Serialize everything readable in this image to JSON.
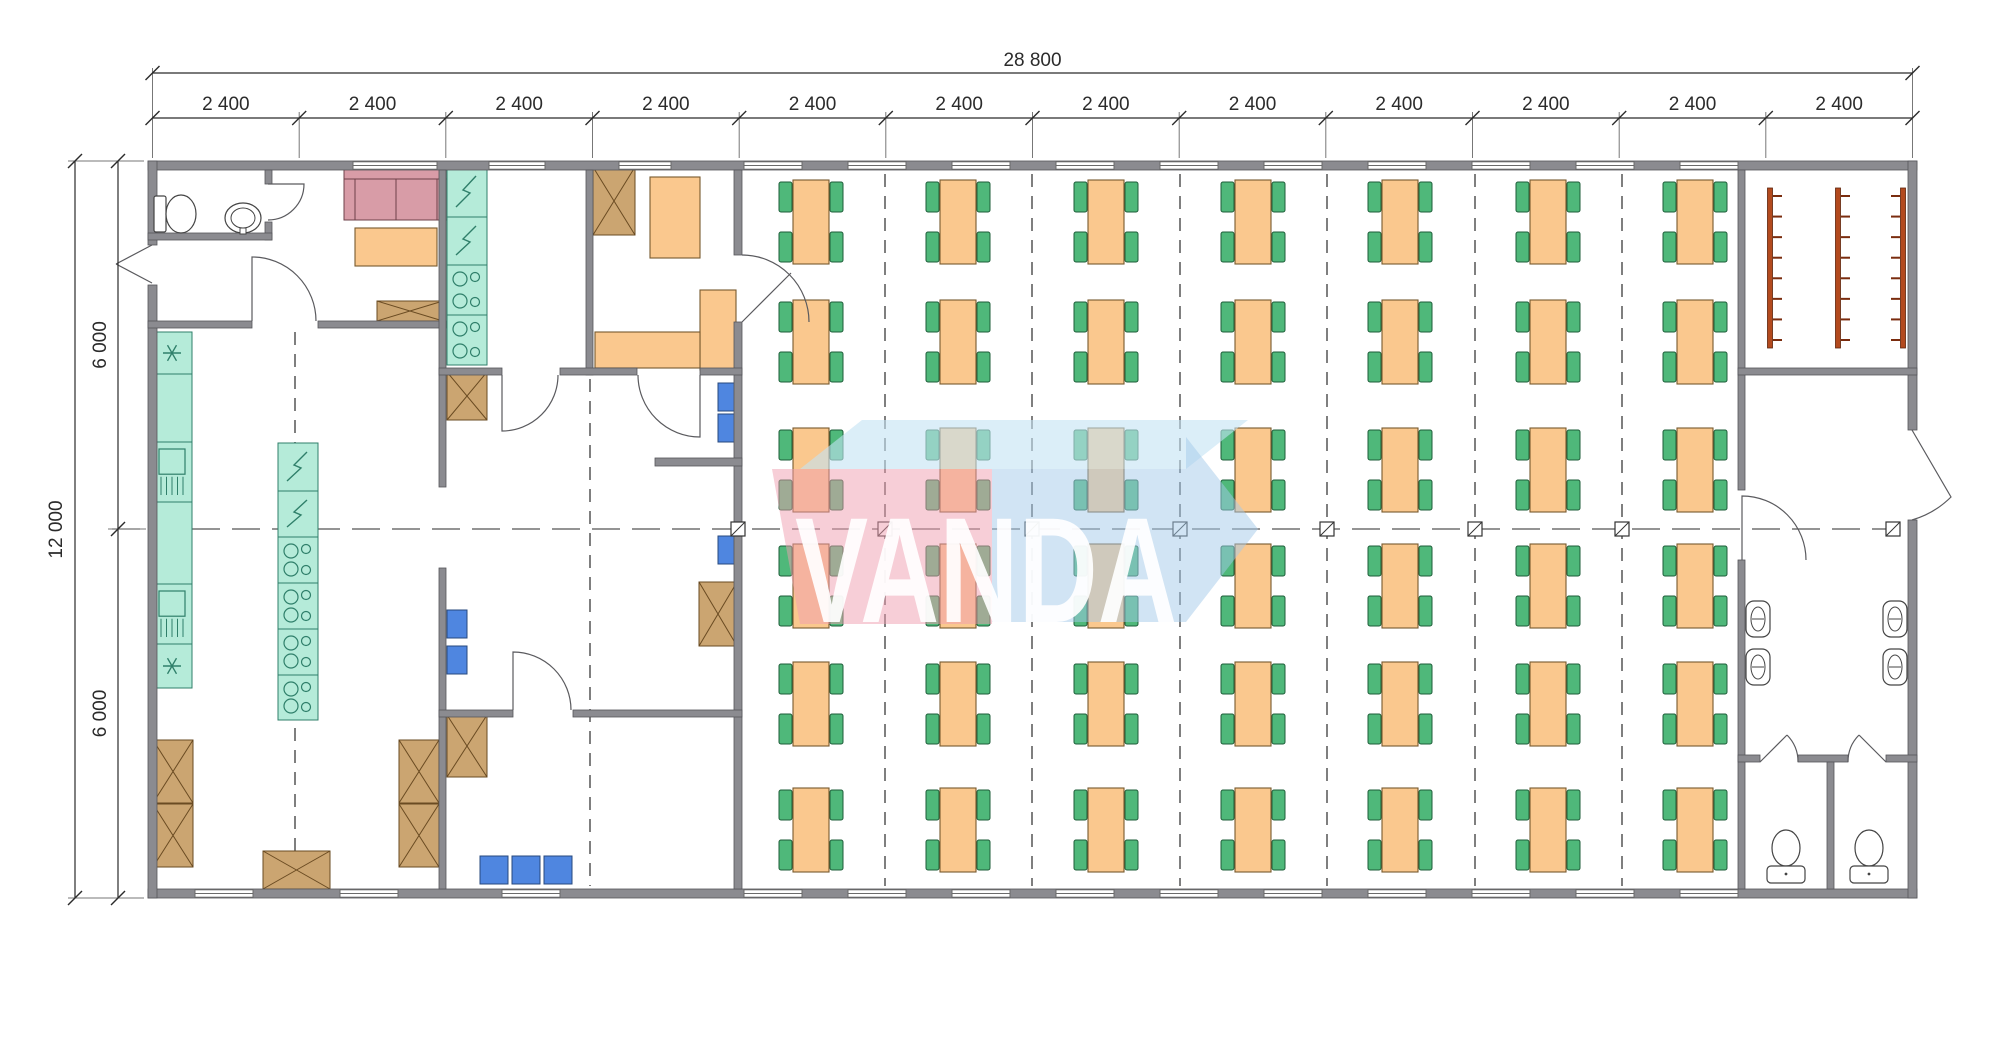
{
  "dimensions": {
    "overall_width": "28 800",
    "bay_label": "2 400",
    "bay_count": 12,
    "overall_height": "12 000",
    "half_height_label": "6 000"
  },
  "watermark": {
    "text": "VANDA",
    "pink": "#ef9db0",
    "blue": "#a3c9e9",
    "top_face": "#c3e2f4",
    "text_color": "#ffffff",
    "top_poly": "800,469 862,420 1248,420 1186,469",
    "pink_poly": "772,469 992,469 992,624 800,624",
    "blue_poly": "992,469 1186,469 1186,437 1258,529 1186,622 992,622",
    "text_x": 795,
    "text_y": 622,
    "text_size": 150,
    "text_length": 382
  },
  "colors": {
    "wall": "#8b8b90",
    "wall_edge": "#55555a",
    "teal": "#b5ebd9",
    "teal_stroke": "#2f7f6a",
    "orange": "#fac88e",
    "orange_stroke": "#77592e",
    "green": "#4fb87a",
    "green_stroke": "#1d5c38",
    "brown": "#cba571",
    "brown_stroke": "#6a4b22",
    "pink": "#d89ca7",
    "pink_stroke": "#6e4049",
    "blue": "#4f86e0",
    "blue_stroke": "#27487e",
    "rack": "#b34a1e",
    "rack_stroke": "#5e230b",
    "rack_tick": "#7a2c0e",
    "dash": "#555555",
    "dim": "#2b2b2b",
    "ext": "#777777",
    "door": "#5a5a5e",
    "fixture": "#444444",
    "window_stroke": "#6a6a6a"
  },
  "plan": {
    "walls": [
      [
        148,
        161,
        1769,
        9
      ],
      [
        148,
        889,
        1769,
        9
      ],
      [
        148,
        161,
        9,
        84
      ],
      [
        148,
        285,
        9,
        613
      ],
      [
        1908,
        161,
        9,
        269
      ],
      [
        1908,
        520,
        9,
        378
      ],
      [
        265,
        170,
        7,
        14
      ],
      [
        265,
        222,
        7,
        18
      ],
      [
        148,
        233,
        124,
        7
      ],
      [
        148,
        321,
        104,
        7
      ],
      [
        318,
        321,
        128,
        7
      ],
      [
        439,
        170,
        7,
        317
      ],
      [
        439,
        568,
        7,
        321
      ],
      [
        586,
        170,
        7,
        205
      ],
      [
        734,
        170,
        8,
        85
      ],
      [
        734,
        322,
        8,
        567
      ],
      [
        439,
        368,
        63,
        7
      ],
      [
        560,
        368,
        77,
        7
      ],
      [
        700,
        368,
        42,
        7
      ],
      [
        655,
        458,
        87,
        8
      ],
      [
        439,
        710,
        74,
        7
      ],
      [
        573,
        710,
        169,
        7
      ],
      [
        1738,
        170,
        7,
        320
      ],
      [
        1738,
        560,
        7,
        329
      ],
      [
        1738,
        368,
        179,
        7
      ],
      [
        1738,
        755,
        22,
        7
      ],
      [
        1798,
        755,
        50,
        7
      ],
      [
        1886,
        755,
        31,
        7
      ],
      [
        1827,
        762,
        7,
        127
      ]
    ],
    "windows": {
      "top": [
        [
          395,
          84
        ],
        [
          517,
          56
        ],
        [
          645,
          52
        ],
        [
          773,
          58
        ],
        [
          877,
          58
        ],
        [
          981,
          58
        ],
        [
          1085,
          58
        ],
        [
          1189,
          58
        ],
        [
          1293,
          58
        ],
        [
          1397,
          58
        ],
        [
          1501,
          58
        ],
        [
          1605,
          58
        ],
        [
          1709,
          58
        ]
      ],
      "bottom": [
        [
          224,
          58
        ],
        [
          369,
          58
        ],
        [
          531,
          58
        ],
        [
          773,
          58
        ],
        [
          877,
          58
        ],
        [
          981,
          58
        ],
        [
          1085,
          58
        ],
        [
          1189,
          58
        ],
        [
          1293,
          58
        ],
        [
          1397,
          58
        ],
        [
          1501,
          58
        ],
        [
          1605,
          58
        ],
        [
          1709,
          58
        ]
      ]
    },
    "doors": [
      "M 152 245 L 116 264 M 152 283 L 116 264",
      "M 268 184 L 304 184 A 36 36 0 0 1 268 220",
      "M 252 321 L 252 257 A 64 64 0 0 1 316 321",
      "M 502 375 L 502 431 A 56 56 0 0 0 558 375",
      "M 700 375 L 700 437 A 62 62 0 0 1 638 375",
      "M 742 255 A 67 67 0 0 1 809 322 M 742 322 L 791 273",
      "M 513 710 L 513 652 A 58 58 0 0 1 571 710",
      "M 1742 560 L 1742 496 A 64 64 0 0 1 1806 560",
      "M 1760 762 L 1787 735 M 1798 762 A 38 38 0 0 0 1787 735",
      "M 1886 762 L 1859 735 M 1848 762 A 38 38 0 0 1 1859 735",
      "M 1912 430 L 1951 497 A 92 92 0 0 1 1912 520"
    ],
    "dashed_vlines": [
      [
        295,
        332,
        886
      ],
      [
        590,
        379,
        886
      ],
      [
        885,
        174,
        886
      ],
      [
        1032,
        174,
        886
      ],
      [
        1180,
        174,
        886
      ],
      [
        1327,
        174,
        886
      ],
      [
        1475,
        174,
        886
      ],
      [
        1622,
        174,
        886
      ]
    ],
    "centerline": {
      "y": 529,
      "x1": 112,
      "x2": 1906
    },
    "markers_x": [
      738,
      885,
      1032,
      1180,
      1327,
      1475,
      1622,
      1893
    ],
    "dining": {
      "col_centers": [
        811,
        958,
        1106,
        1253,
        1400,
        1548,
        1695
      ],
      "row_centers": [
        222,
        342,
        470,
        586,
        704,
        830
      ],
      "table_w": 36,
      "table_h": 84,
      "chair_w": 13,
      "chair_h": 30
    },
    "teal_runs": [
      {
        "x": 152,
        "y": 332,
        "w": 40,
        "cells": [
          {
            "h": 42,
            "t": "snow"
          },
          {
            "h": 68,
            "t": "plain"
          },
          {
            "h": 60,
            "t": "sink"
          },
          {
            "h": 82,
            "t": "plain"
          },
          {
            "h": 60,
            "t": "sink"
          },
          {
            "h": 44,
            "t": "snow"
          }
        ]
      },
      {
        "x": 447,
        "y": 167,
        "w": 40,
        "cells": [
          {
            "h": 50,
            "t": "flash"
          },
          {
            "h": 48,
            "t": "flash"
          },
          {
            "h": 50,
            "t": "stove"
          },
          {
            "h": 50,
            "t": "stove"
          }
        ]
      },
      {
        "x": 278,
        "y": 443,
        "w": 40,
        "cells": [
          {
            "h": 48,
            "t": "flash"
          },
          {
            "h": 46,
            "t": "flash"
          },
          {
            "h": 46,
            "t": "stove"
          },
          {
            "h": 46,
            "t": "stove"
          },
          {
            "h": 46,
            "t": "stove"
          },
          {
            "h": 45,
            "t": "stove"
          }
        ]
      }
    ],
    "sofa": {
      "back": [
        344,
        167,
        104,
        12
      ],
      "arm_left": [
        344,
        179,
        11,
        41
      ],
      "arm_right": [
        437,
        179,
        11,
        41
      ],
      "seats": [
        [
          355,
          179,
          41,
          41
        ],
        [
          396,
          179,
          41,
          41
        ]
      ]
    },
    "orange_items": [
      [
        355,
        228,
        82,
        38
      ],
      [
        650,
        177,
        50,
        81
      ],
      [
        700,
        290,
        36,
        80
      ],
      [
        595,
        332,
        105,
        36
      ]
    ],
    "crossed_boxes": [
      [
        377,
        301,
        66,
        20
      ],
      [
        593,
        167,
        42,
        68
      ],
      [
        447,
        372,
        40,
        48
      ],
      [
        699,
        582,
        38,
        64
      ],
      [
        447,
        715,
        40,
        62
      ],
      [
        399,
        740,
        40,
        63
      ],
      [
        399,
        804,
        40,
        63
      ],
      [
        153,
        740,
        40,
        63
      ],
      [
        153,
        804,
        40,
        63
      ],
      [
        263,
        851,
        67,
        38
      ]
    ],
    "blue_items": [
      [
        718,
        383,
        18,
        28
      ],
      [
        718,
        414,
        18,
        28
      ],
      [
        718,
        536,
        18,
        28
      ],
      [
        447,
        610,
        20,
        28
      ],
      [
        447,
        646,
        20,
        28
      ],
      [
        480,
        856,
        28,
        28
      ],
      [
        512,
        856,
        28,
        28
      ],
      [
        544,
        856,
        28,
        28
      ]
    ],
    "racks": {
      "y": 188,
      "h": 160,
      "tick_count": 8,
      "bars": [
        {
          "x": 1770,
          "side": 1
        },
        {
          "x": 1838,
          "side": 1
        },
        {
          "x": 1903,
          "side": -1
        }
      ]
    },
    "toilet_room": {
      "tank": [
        154,
        196,
        12,
        36
      ],
      "bowl_cx": 181,
      "bowl_cy": 214,
      "bowl_rx": 15,
      "bowl_ry": 19,
      "sink_cx": 243,
      "sink_cy": 218,
      "sink_rx": 18,
      "sink_ry": 15
    },
    "washroom": {
      "sinks": [
        [
          1758,
          619
        ],
        [
          1758,
          667
        ],
        [
          1895,
          619
        ],
        [
          1895,
          667
        ]
      ],
      "wcs": [
        1786,
        1869
      ]
    },
    "dims": {
      "axis_x": [
        152.5,
        299.2,
        445.8,
        592.5,
        739.2,
        885.8,
        1032.5,
        1179.2,
        1325.8,
        1472.5,
        1619.2,
        1765.8,
        1912.5
      ],
      "tier1_y": 73,
      "tier2_y": 118,
      "left_tier1_x": 75,
      "left_tier2_x": 118,
      "axis_y": [
        161,
        529,
        898
      ]
    }
  }
}
